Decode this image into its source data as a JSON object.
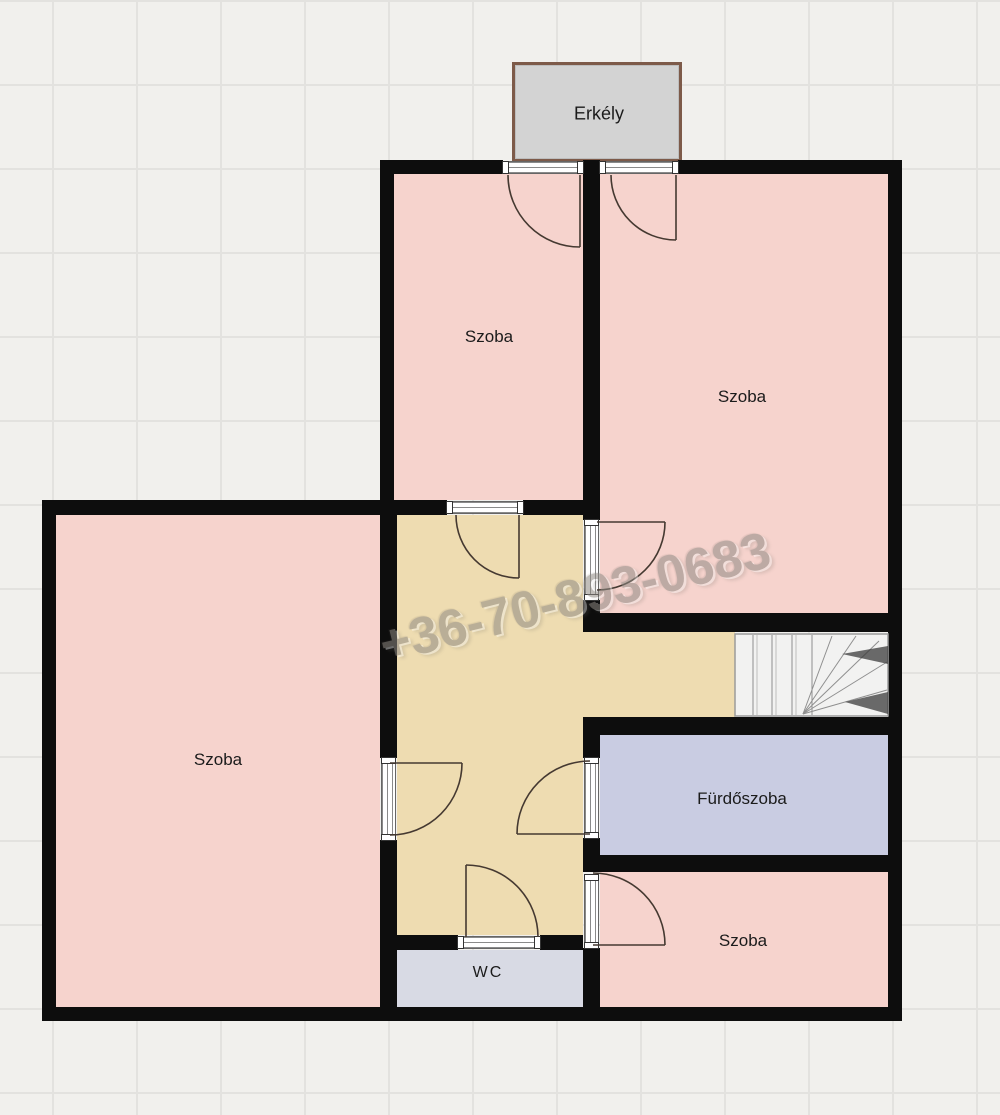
{
  "watermark": {
    "text": "+36-70-893-0683"
  },
  "rooms": {
    "balcony": {
      "label": "Erkély"
    },
    "room_top_left": {
      "label": "Szoba"
    },
    "room_top_right": {
      "label": "Szoba"
    },
    "room_left": {
      "label": "Szoba"
    },
    "bathroom": {
      "label": "Fürdőszoba"
    },
    "room_bottom_right": {
      "label": "Szoba"
    },
    "wc": {
      "label": "WC"
    }
  },
  "colors": {
    "background": "#f1f0ed",
    "grid_line": "#e3e2df",
    "wall": "#0d0d0d",
    "room_fill": "#f6d3cd",
    "hallway_fill": "#eedcb1",
    "bathroom_fill": "#c9cce2",
    "wc_fill": "#d8dae4",
    "balcony_fill": "#d3d3d3",
    "balcony_border": "#7d5a49",
    "stairs_fill": "#f2f2f1",
    "watermark_text": "#8f8a83"
  }
}
